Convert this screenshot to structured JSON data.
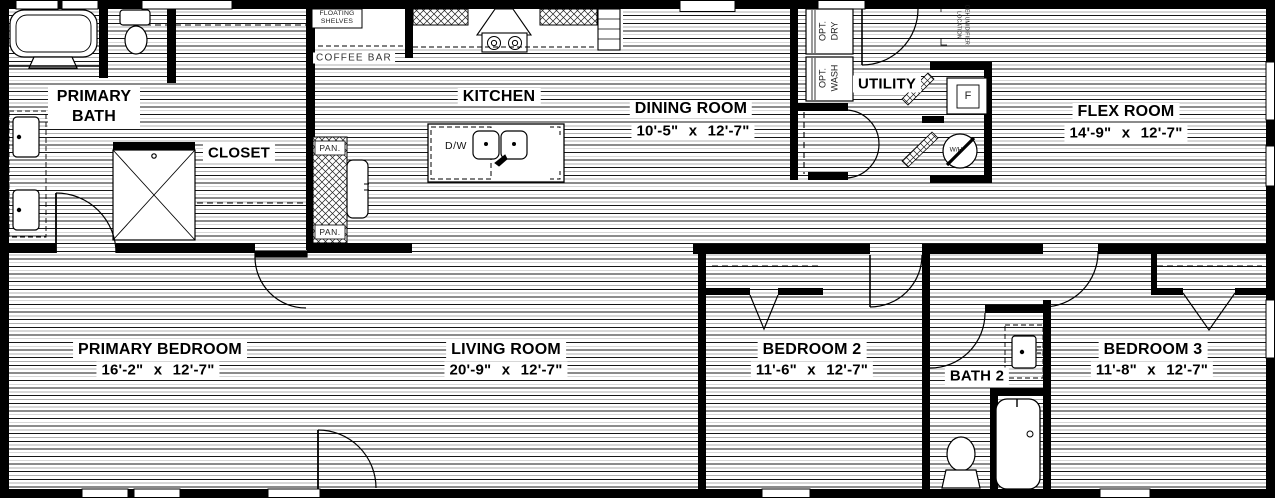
{
  "floorplan": {
    "rooms": [
      {
        "name": "PRIMARY BATH",
        "dims": ""
      },
      {
        "name": "CLOSET",
        "dims": ""
      },
      {
        "name": "KITCHEN",
        "dims": ""
      },
      {
        "name": "DINING ROOM",
        "dims": "10'-5\" x 12'-7\""
      },
      {
        "name": "UTILITY",
        "dims": ""
      },
      {
        "name": "FLEX ROOM",
        "dims": "14'-9\" x 12'-7\""
      },
      {
        "name": "PRIMARY BEDROOM",
        "dims": "16'-2\" x 12'-7\""
      },
      {
        "name": "LIVING ROOM",
        "dims": "20'-9\" x 12'-7\""
      },
      {
        "name": "BEDROOM 2",
        "dims": "11'-6\" x 12'-7\""
      },
      {
        "name": "BATH 2",
        "dims": ""
      },
      {
        "name": "BEDROOM 3",
        "dims": "11'-8\" x 12'-7\""
      }
    ],
    "annotations": {
      "floating_shelves_1": "FLOATING",
      "floating_shelves_2": "SHELVES",
      "coffee_bar": "COFFEE BAR",
      "pantry_top": "PAN.",
      "pantry_bottom": "PAN.",
      "dishwasher": "D/W",
      "opt_dry_1": "OPT.",
      "opt_dry_2": "DRY",
      "opt_wash_1": "OPT.",
      "opt_wash_2": "WASH",
      "dehumidifier_1": "DEHUMIDIFIER",
      "dehumidifier_2": "LOCATION",
      "furnace": "F",
      "water_heater": "W/H"
    },
    "colors": {
      "wall": "#000000",
      "floor_line": "#171717",
      "background": "#ffffff"
    }
  }
}
